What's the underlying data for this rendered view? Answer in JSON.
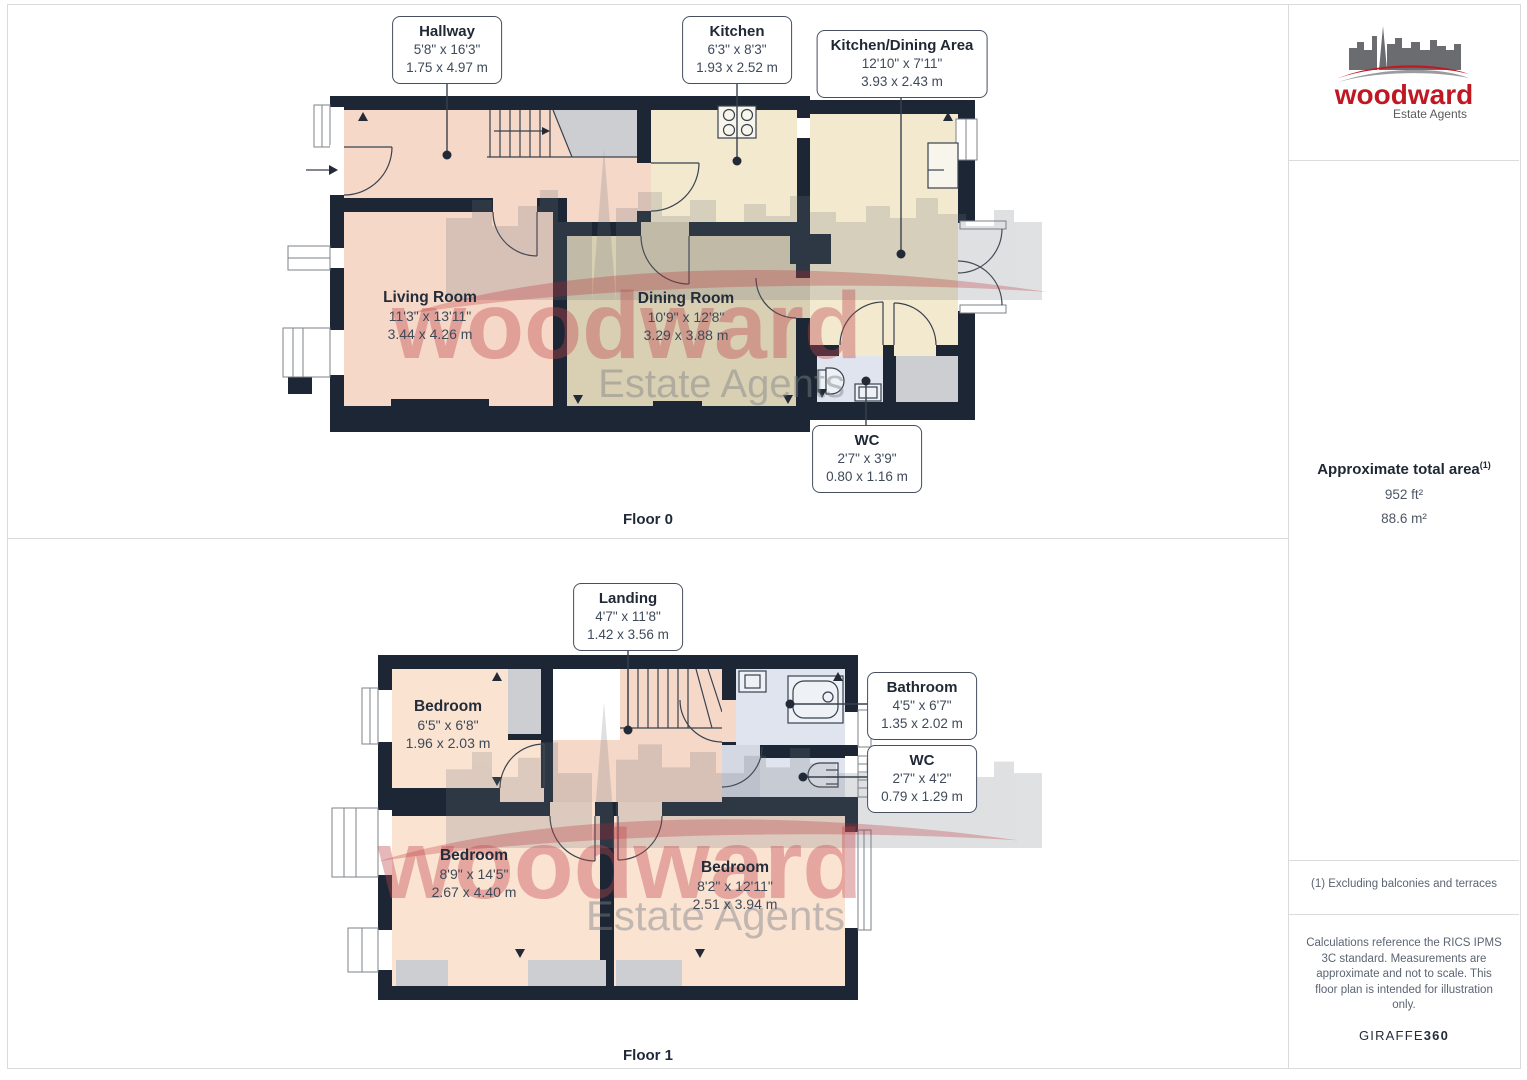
{
  "floor0": {
    "caption": "Floor 0",
    "boxed_labels": {
      "hallway": {
        "title": "Hallway",
        "imperial": "5'8\" x 16'3\"",
        "metric": "1.75 x 4.97 m"
      },
      "kitchen": {
        "title": "Kitchen",
        "imperial": "6'3\" x 8'3\"",
        "metric": "1.93 x 2.52 m"
      },
      "kitchen_dining": {
        "title": "Kitchen/Dining Area",
        "imperial": "12'10\" x 7'11\"",
        "metric": "3.93 x 2.43 m"
      },
      "wc": {
        "title": "WC",
        "imperial": "2'7\" x 3'9\"",
        "metric": "0.80 x 1.16 m"
      }
    },
    "room_labels": {
      "living_room": {
        "title": "Living Room",
        "imperial": "11'3\" x 13'11\"",
        "metric": "3.44 x 4.26 m"
      },
      "dining_room": {
        "title": "Dining Room",
        "imperial": "10'9\" x 12'8\"",
        "metric": "3.29 x 3.88 m"
      }
    }
  },
  "floor1": {
    "caption": "Floor 1",
    "boxed_labels": {
      "landing": {
        "title": "Landing",
        "imperial": "4'7\" x 11'8\"",
        "metric": "1.42 x 3.56 m"
      },
      "bathroom": {
        "title": "Bathroom",
        "imperial": "4'5\" x 6'7\"",
        "metric": "1.35 x 2.02 m"
      },
      "wc": {
        "title": "WC",
        "imperial": "2'7\" x 4'2\"",
        "metric": "0.79 x 1.29 m"
      }
    },
    "room_labels": {
      "bedroom_small": {
        "title": "Bedroom",
        "imperial": "6'5\" x 6'8\"",
        "metric": "1.96 x 2.03 m"
      },
      "bedroom_left": {
        "title": "Bedroom",
        "imperial": "8'9\" x 14'5\"",
        "metric": "2.67 x 4.40 m"
      },
      "bedroom_right": {
        "title": "Bedroom",
        "imperial": "8'2\" x 12'11\"",
        "metric": "2.51 x 3.94 m"
      }
    }
  },
  "watermark": {
    "brand": "woodward",
    "tagline": "Estate Agents"
  },
  "sidebar": {
    "logo": {
      "brand": "woodward",
      "tagline": "Estate Agents"
    },
    "area_summary": {
      "title": "Approximate total area",
      "footnote_marker": "(1)",
      "imperial": "952 ft²",
      "metric": "88.6 m²"
    },
    "footnote": "(1) Excluding balconies and terraces",
    "disclaimer": "Calculations reference the RICS IPMS 3C standard. Measurements are approximate and not to scale. This floor plan is intended for illustration only.",
    "provider": {
      "name": "GIRAFFE",
      "suffix": "360"
    }
  },
  "colors": {
    "wall": "#1c2634",
    "room_pink": "#f5d8c8",
    "room_pink_light": "#fbe3d1",
    "room_beige": "#f2e9cf",
    "room_olive": "#d9cfb3",
    "room_blue": "#dfe4ee",
    "recess_gray": "#cdced1",
    "brand_red": "#c01823",
    "logo_gray": "#6a6c70"
  }
}
